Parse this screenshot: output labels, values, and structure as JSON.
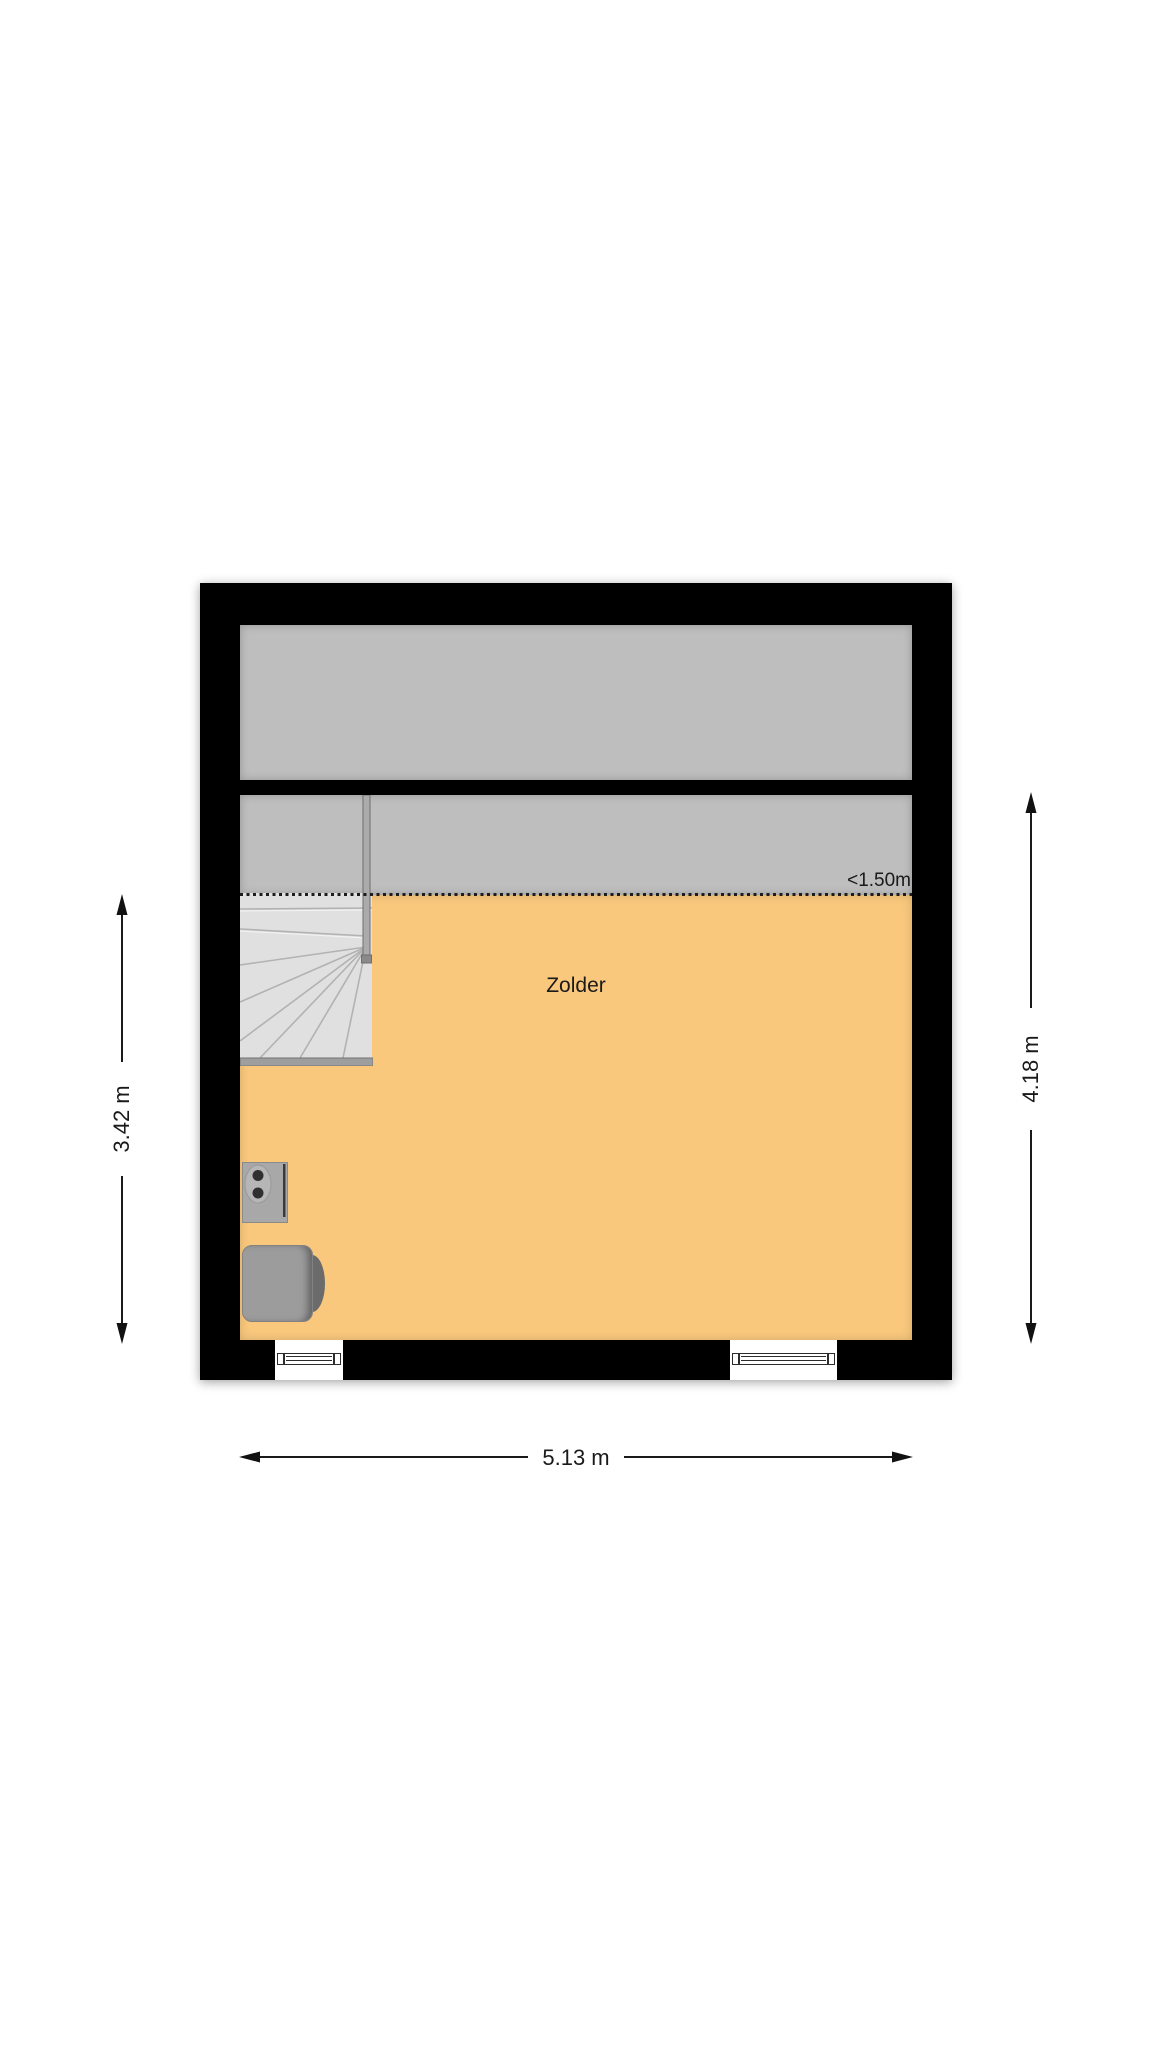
{
  "plan": {
    "room_label": "Zolder",
    "headroom_label": "<1.50m",
    "dimensions": {
      "left": "3.42 m",
      "right": "4.18 m",
      "bottom": "5.13 m"
    },
    "colors": {
      "wall": "#000000",
      "low_headroom_area": "#BEBEBE",
      "floor": "#F9C87D",
      "stairs": "#E2E2E2",
      "background": "#FFFFFF",
      "dimension_text": "#1A1A1A"
    }
  }
}
